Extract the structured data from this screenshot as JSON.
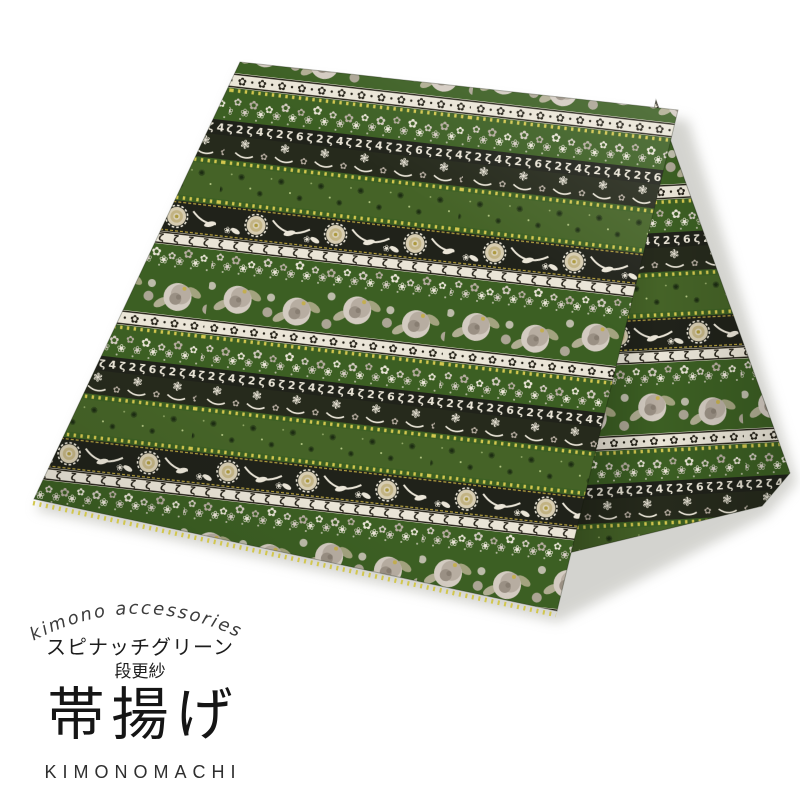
{
  "page": {
    "background": "#ffffff"
  },
  "label": {
    "arc_text": "kimono accessories",
    "color_name": "スピナッチグリーン",
    "pattern_name": "段更紗",
    "product_name": "帯揚げ",
    "brand": "KIMONOMACHI"
  },
  "fabric": {
    "colors": {
      "green": "#3c5f23",
      "green_plain": "#456327",
      "black": "#20221a",
      "black2": "#262a1c",
      "cream": "#eae5d7",
      "ink": "#232016",
      "flower_light": "#d3cbc1",
      "flower_mid": "#b7ada1",
      "flower_deep": "#9a9084",
      "rose_core": "#887e72",
      "leaf": "#b0ad92",
      "leaf2": "#a3a37f",
      "yellow_dot": "#d2c74e",
      "yellow_accent": "#c6ae42",
      "peony_outer": "#d7cdb2",
      "peony_mid": "#c2b383",
      "peony_inner": "#d9d0b8",
      "peony_core": "#ad9a3f",
      "speck": "#cfe09b",
      "sprig_dark": "#1c2c12",
      "shadow": "#a9a9a0"
    },
    "glyphs": {
      "flower": "✿",
      "flower_outline": "❀",
      "spray": "❃",
      "sprig": "✺",
      "scroll": "✿",
      "curl": "ζ",
      "letters": "ζ2ζ4ζ2ζ6ζ2ζ4"
    },
    "bands": [
      {
        "type": "roses",
        "h": 46,
        "bg": "green"
      },
      {
        "type": "scroll",
        "h": 15,
        "bg": "cream"
      },
      {
        "type": "dots",
        "h": 5,
        "bg": "green"
      },
      {
        "type": "flowers",
        "h": 28,
        "bg": "green"
      },
      {
        "type": "letters",
        "h": 15,
        "bg": "black"
      },
      {
        "type": "vine",
        "h": 24,
        "bg": "black2"
      },
      {
        "type": "dots",
        "h": 6,
        "bg": "green"
      },
      {
        "type": "plain",
        "h": 34,
        "bg": "green_plain"
      },
      {
        "type": "dots",
        "h": 6,
        "bg": "green"
      },
      {
        "type": "peony",
        "h": 32,
        "bg": "black"
      },
      {
        "type": "scroll2",
        "h": 13,
        "bg": "cream"
      },
      {
        "type": "flowers",
        "h": 24,
        "bg": "green"
      }
    ]
  }
}
